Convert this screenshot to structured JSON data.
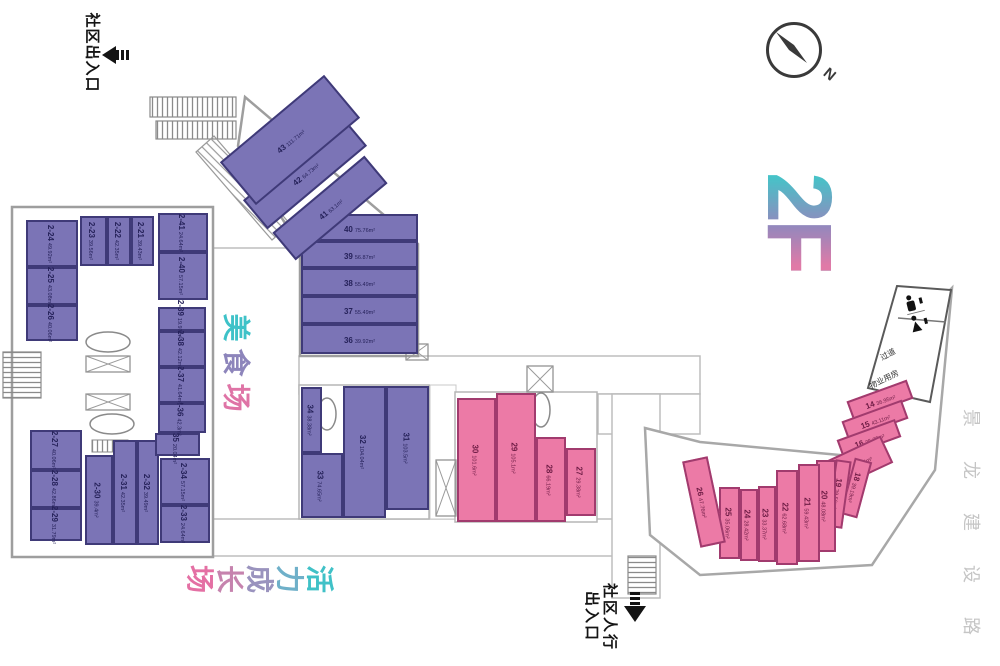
{
  "floor": "2F",
  "compass_north": "N",
  "labels": {
    "entrance_top": "社区出入口",
    "entrance_bottom_line1": "社区人行",
    "entrance_bottom_line2": "出入口",
    "food_court": "美食场",
    "vitality_zone": "活力成长场",
    "road": "景龙建设路",
    "corridor": "过道",
    "property_room": "物业用房"
  },
  "colors": {
    "purple_fill": "#7b74b6",
    "purple_border": "#3f3a78",
    "pink_fill": "#ec7aa6",
    "pink_border": "#a13b6e",
    "teal_accent": "#3ec2c8",
    "logo_gradient": [
      "#46c3c8",
      "#9388bd",
      "#e07aa7"
    ],
    "food_court_chars": [
      "#3ec2c8",
      "#8d85bb",
      "#df74a6"
    ],
    "vitality_chars": [
      "#40c1c7",
      "#6fb0c9",
      "#9a93be",
      "#c683ae",
      "#e470a4"
    ]
  },
  "units": [
    {
      "id": "14",
      "area": "36.95m²",
      "x": 848,
      "y": 390,
      "w": 64,
      "h": 20,
      "c": "k",
      "lr": "h",
      "rot": -20
    },
    {
      "id": "15",
      "area": "43.11m²",
      "x": 843,
      "y": 410,
      "w": 64,
      "h": 20,
      "c": "k",
      "lr": "h",
      "rot": -20
    },
    {
      "id": "16",
      "area": "35.73m²",
      "x": 838,
      "y": 429,
      "w": 62,
      "h": 19,
      "c": "k",
      "lr": "h",
      "rot": -20
    },
    {
      "id": "17",
      "area": "55.54m²",
      "x": 824,
      "y": 448,
      "w": 66,
      "h": 30,
      "c": "k",
      "lr": "h",
      "rot": -25
    },
    {
      "id": "18",
      "area": "39.19m²",
      "x": 847,
      "y": 459,
      "w": 18,
      "h": 58,
      "c": "k",
      "lr": "v",
      "rot": 15
    },
    {
      "id": "19",
      "area": "39.56m²",
      "x": 831,
      "y": 460,
      "w": 16,
      "h": 68,
      "c": "k",
      "lr": "v",
      "rot": 8
    },
    {
      "id": "20",
      "area": "48.08m²",
      "x": 816,
      "y": 460,
      "w": 20,
      "h": 92,
      "c": "k",
      "lr": "v"
    },
    {
      "id": "21",
      "area": "59.43m²",
      "x": 798,
      "y": 464,
      "w": 22,
      "h": 98,
      "c": "k",
      "lr": "v"
    },
    {
      "id": "22",
      "area": "62.68m²",
      "x": 776,
      "y": 470,
      "w": 22,
      "h": 95,
      "c": "k",
      "lr": "v"
    },
    {
      "id": "23",
      "area": "33.37m²",
      "x": 758,
      "y": 486,
      "w": 18,
      "h": 76,
      "c": "k",
      "lr": "v"
    },
    {
      "id": "24",
      "area": "28.42m²",
      "x": 740,
      "y": 489,
      "w": 18,
      "h": 72,
      "c": "k",
      "lr": "v"
    },
    {
      "id": "25",
      "area": "35.06m²",
      "x": 719,
      "y": 487,
      "w": 21,
      "h": 72,
      "c": "k",
      "lr": "v"
    },
    {
      "id": "26",
      "area": "47.76m²",
      "x": 691,
      "y": 458,
      "w": 26,
      "h": 88,
      "c": "k",
      "lr": "v",
      "rot": -12
    },
    {
      "id": "27",
      "area": "29.38m²",
      "x": 566,
      "y": 448,
      "w": 30,
      "h": 68,
      "c": "k",
      "lr": "v"
    },
    {
      "id": "28",
      "area": "66.19m²",
      "x": 536,
      "y": 437,
      "w": 30,
      "h": 85,
      "c": "k",
      "lr": "v"
    },
    {
      "id": "29",
      "area": "105.1m²",
      "x": 496,
      "y": 393,
      "w": 40,
      "h": 129,
      "c": "k",
      "lr": "v"
    },
    {
      "id": "30",
      "area": "101.6m²",
      "x": 457,
      "y": 398,
      "w": 39,
      "h": 124,
      "c": "k",
      "lr": "v"
    },
    {
      "id": "31",
      "area": "103.5m²",
      "x": 386,
      "y": 386,
      "w": 43,
      "h": 124,
      "c": "p",
      "lr": "v"
    },
    {
      "id": "32",
      "area": "104.04m²",
      "x": 343,
      "y": 386,
      "w": 43,
      "h": 132,
      "c": "p",
      "lr": "v"
    },
    {
      "id": "33",
      "area": "74.65m²",
      "x": 301,
      "y": 453,
      "w": 42,
      "h": 65,
      "c": "p",
      "lr": "v"
    },
    {
      "id": "34",
      "area": "38.38m²",
      "x": 301,
      "y": 387,
      "w": 21,
      "h": 66,
      "c": "p",
      "lr": "v"
    },
    {
      "id": "36",
      "area": "39.92m²",
      "x": 301,
      "y": 324,
      "w": 117,
      "h": 30,
      "c": "p",
      "lr": "h"
    },
    {
      "id": "37",
      "area": "55.49m²",
      "x": 301,
      "y": 296,
      "w": 117,
      "h": 28,
      "c": "p",
      "lr": "h"
    },
    {
      "id": "38",
      "area": "55.49m²",
      "x": 301,
      "y": 268,
      "w": 117,
      "h": 28,
      "c": "p",
      "lr": "h"
    },
    {
      "id": "39",
      "area": "56.87m²",
      "x": 301,
      "y": 241,
      "w": 117,
      "h": 27,
      "c": "p",
      "lr": "h"
    },
    {
      "id": "40",
      "area": "75.76m²",
      "x": 301,
      "y": 214,
      "w": 117,
      "h": 27,
      "c": "p",
      "lr": "h"
    },
    {
      "id": "41",
      "area": "63.1m²",
      "x": 270,
      "y": 190,
      "w": 120,
      "h": 36,
      "c": "p",
      "lr": "h",
      "rot": -40
    },
    {
      "id": "42",
      "area": "64.73m²",
      "x": 240,
      "y": 154,
      "w": 130,
      "h": 38,
      "c": "p",
      "lr": "h",
      "rot": -40
    },
    {
      "id": "43",
      "area": "111.71m²",
      "x": 222,
      "y": 112,
      "w": 136,
      "h": 56,
      "c": "p",
      "lr": "h",
      "rot": -40
    },
    {
      "id": "2-21",
      "area": "39.43m²",
      "x": 131,
      "y": 216,
      "w": 23,
      "h": 50,
      "c": "p",
      "lr": "v"
    },
    {
      "id": "2-22",
      "area": "42.35m²",
      "x": 107,
      "y": 216,
      "w": 24,
      "h": 50,
      "c": "p",
      "lr": "v"
    },
    {
      "id": "2-23",
      "area": "39.56m²",
      "x": 80,
      "y": 216,
      "w": 27,
      "h": 50,
      "c": "p",
      "lr": "v"
    },
    {
      "id": "2-24",
      "area": "49.92m²",
      "x": 26,
      "y": 220,
      "w": 52,
      "h": 47,
      "c": "p",
      "lr": "v"
    },
    {
      "id": "2-25",
      "area": "43.08m²",
      "x": 26,
      "y": 267,
      "w": 52,
      "h": 38,
      "c": "p",
      "lr": "v"
    },
    {
      "id": "2-26",
      "area": "40.06m²",
      "x": 26,
      "y": 305,
      "w": 52,
      "h": 36,
      "c": "p",
      "lr": "v"
    },
    {
      "id": "2-27",
      "area": "40.06m²",
      "x": 30,
      "y": 430,
      "w": 52,
      "h": 40,
      "c": "p",
      "lr": "v"
    },
    {
      "id": "2-28",
      "area": "42.86m²",
      "x": 30,
      "y": 470,
      "w": 52,
      "h": 38,
      "c": "p",
      "lr": "v"
    },
    {
      "id": "2-29",
      "area": "31.79m²",
      "x": 30,
      "y": 508,
      "w": 52,
      "h": 33,
      "c": "p",
      "lr": "v"
    },
    {
      "id": "2-30",
      "area": "39.4m²",
      "x": 85,
      "y": 455,
      "w": 28,
      "h": 90,
      "c": "p",
      "lr": "v"
    },
    {
      "id": "2-31",
      "area": "42.35m²",
      "x": 113,
      "y": 440,
      "w": 24,
      "h": 105,
      "c": "p",
      "lr": "v"
    },
    {
      "id": "2-32",
      "area": "39.49m²",
      "x": 137,
      "y": 440,
      "w": 22,
      "h": 105,
      "c": "p",
      "lr": "v"
    },
    {
      "id": "2-33",
      "area": "24.64m²",
      "x": 160,
      "y": 505,
      "w": 50,
      "h": 38,
      "c": "p",
      "lr": "v"
    },
    {
      "id": "2-34",
      "area": "57.15m²",
      "x": 160,
      "y": 458,
      "w": 50,
      "h": 47,
      "c": "p",
      "lr": "v"
    },
    {
      "id": "2-35",
      "area": "20.04m²",
      "x": 155,
      "y": 433,
      "w": 45,
      "h": 23,
      "c": "p",
      "lr": "v"
    },
    {
      "id": "2-36",
      "area": "42.3m²",
      "x": 158,
      "y": 403,
      "w": 48,
      "h": 30,
      "c": "p",
      "lr": "v"
    },
    {
      "id": "2-37",
      "area": "41.64m²",
      "x": 158,
      "y": 367,
      "w": 48,
      "h": 36,
      "c": "p",
      "lr": "v"
    },
    {
      "id": "2-38",
      "area": "42.12m²",
      "x": 158,
      "y": 331,
      "w": 48,
      "h": 36,
      "c": "p",
      "lr": "v"
    },
    {
      "id": "2-39",
      "area": "19.97m²",
      "x": 158,
      "y": 307,
      "w": 48,
      "h": 24,
      "c": "p",
      "lr": "v"
    },
    {
      "id": "2-40",
      "area": "57.15m²",
      "x": 158,
      "y": 252,
      "w": 50,
      "h": 48,
      "c": "p",
      "lr": "v"
    },
    {
      "id": "2-41",
      "area": "24.64m²",
      "x": 158,
      "y": 213,
      "w": 50,
      "h": 39,
      "c": "p",
      "lr": "v"
    }
  ]
}
